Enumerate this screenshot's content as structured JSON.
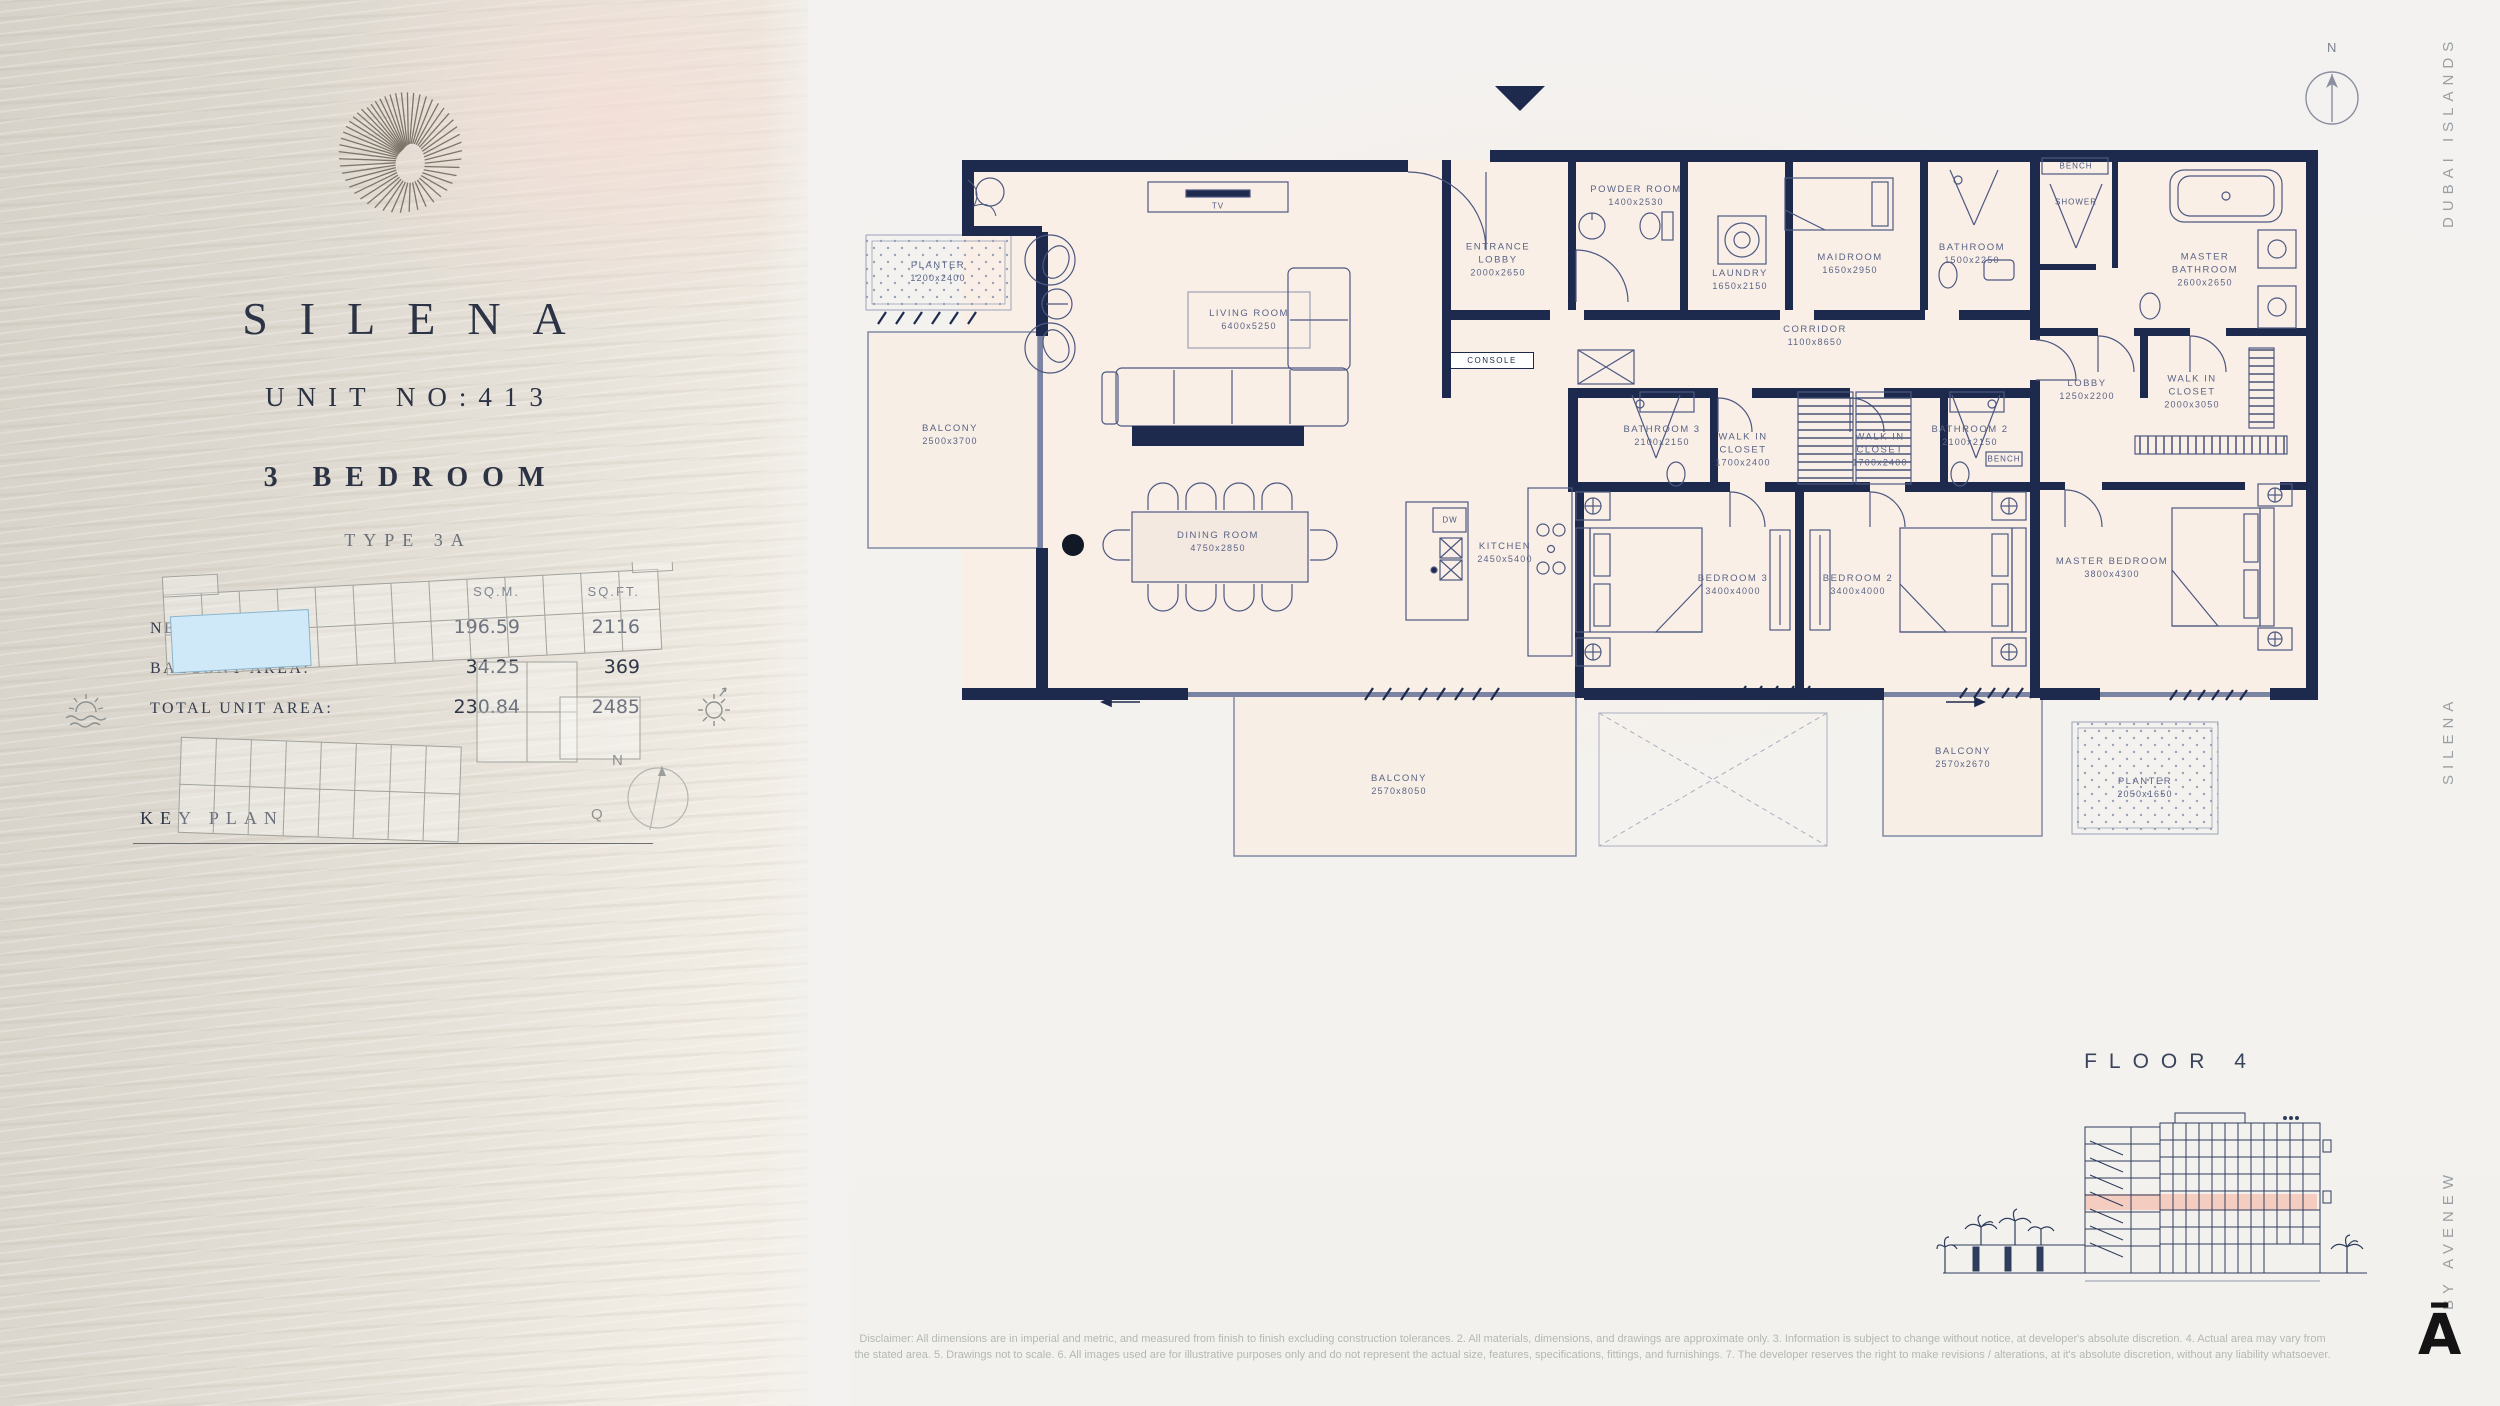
{
  "brand": {
    "title": "SILENA",
    "side_top": "DUBAI ISLANDS",
    "side_mid": "SILENA",
    "side_bottom": "BY AVENEW",
    "mark": "Ā"
  },
  "unit": {
    "unit_no": "UNIT NO:413",
    "bedrooms": "3 BEDROOM",
    "type": "TYPE 3A"
  },
  "areas": {
    "col_sqm": "SQ.M.",
    "col_sqft": "SQ.FT.",
    "rows": [
      {
        "label": "NET AREA:",
        "sqm": "196.59",
        "sqft": "2116"
      },
      {
        "label": "BALCONY AREA:",
        "sqm": "34.25",
        "sqft": "369"
      },
      {
        "label": "TOTAL UNIT AREA:",
        "sqm": "230.84",
        "sqft": "2485"
      }
    ]
  },
  "key_plan": {
    "title": "KEY PLAN",
    "compass_n": "N",
    "compass_q": "Q"
  },
  "plan": {
    "compass_n": "N",
    "rooms": {
      "planter_tl": {
        "name": "PLANTER",
        "dim": "1200x2400"
      },
      "balcony_left": {
        "name": "BALCONY",
        "dim": "2500x3700"
      },
      "living": {
        "name": "LIVING ROOM",
        "dim": "6400x5250"
      },
      "dining": {
        "name": "DINING ROOM",
        "dim": "4750x2850"
      },
      "kitchen": {
        "name": "KITCHEN",
        "dim": "2450x5400"
      },
      "entrance": {
        "name": "ENTRANCE",
        "name2": "LOBBY",
        "dim": "2000x2650"
      },
      "powder": {
        "name": "POWDER ROOM",
        "dim": "1400x2530"
      },
      "laundry": {
        "name": "LAUNDRY",
        "dim": "1650x2150"
      },
      "maid": {
        "name": "MAIDROOM",
        "dim": "1650x2950"
      },
      "bath_maid": {
        "name": "BATHROOM",
        "dim": "1500x2250"
      },
      "corridor": {
        "name": "CORRIDOR",
        "dim": "1100x8650"
      },
      "bath3": {
        "name": "BATHROOM 3",
        "dim": "2100x2150"
      },
      "wic3": {
        "name": "WALK IN",
        "name2": "CLOSET",
        "dim": "1700x2400"
      },
      "wic2": {
        "name": "WALK IN",
        "name2": "CLOSET",
        "dim": "1700x2400"
      },
      "bath2": {
        "name": "BATHROOM 2",
        "dim": "2100x2150"
      },
      "bed3": {
        "name": "BEDROOM 3",
        "dim": "3400x4000"
      },
      "bed2": {
        "name": "BEDROOM 2",
        "dim": "3400x4000"
      },
      "master_bed": {
        "name": "MASTER BEDROOM",
        "dim": "3800x4300"
      },
      "lobby": {
        "name": "LOBBY",
        "dim": "1250x2200"
      },
      "wic_master": {
        "name": "WALK IN",
        "name2": "CLOSET",
        "dim": "2000x3050"
      },
      "master_bath": {
        "name": "MASTER",
        "name2": "BATHROOM",
        "dim": "2600x2650"
      },
      "balcony_bottom": {
        "name": "BALCONY",
        "dim": "2570x8050"
      },
      "balcony_right": {
        "name": "BALCONY",
        "dim": "2570x2670"
      },
      "planter_br": {
        "name": "PLANTER",
        "dim": "2050x1650"
      }
    },
    "fixtures": {
      "tv": "TV",
      "console": "CONSOLE",
      "dw": "DW",
      "bench": "BENCH",
      "shower": "SHOWER"
    }
  },
  "floor": {
    "label": "FLOOR 4"
  },
  "colors": {
    "wall_navy": "#1e2a4d",
    "floor_fill": "#f9efe7",
    "highlight_blue": "#cfe9f8",
    "floor_band_pink": "#f5c9ba"
  },
  "disclaimer": {
    "line1": "Disclaimer: All dimensions are in imperial and metric, and measured from finish to finish excluding construction tolerances. 2. All materials, dimensions, and drawings are approximate only. 3. Information is subject to change without notice, at developer's absolute discretion. 4. Actual area may vary from",
    "line2": "the stated area. 5. Drawings not to scale. 6. All images used are for illustrative purposes only and do not represent the actual size, features, specifications, fittings, and furnishings. 7. The developer reserves the right to make revisions / alterations, at it's absolute discretion, without any liability whatsoever."
  }
}
